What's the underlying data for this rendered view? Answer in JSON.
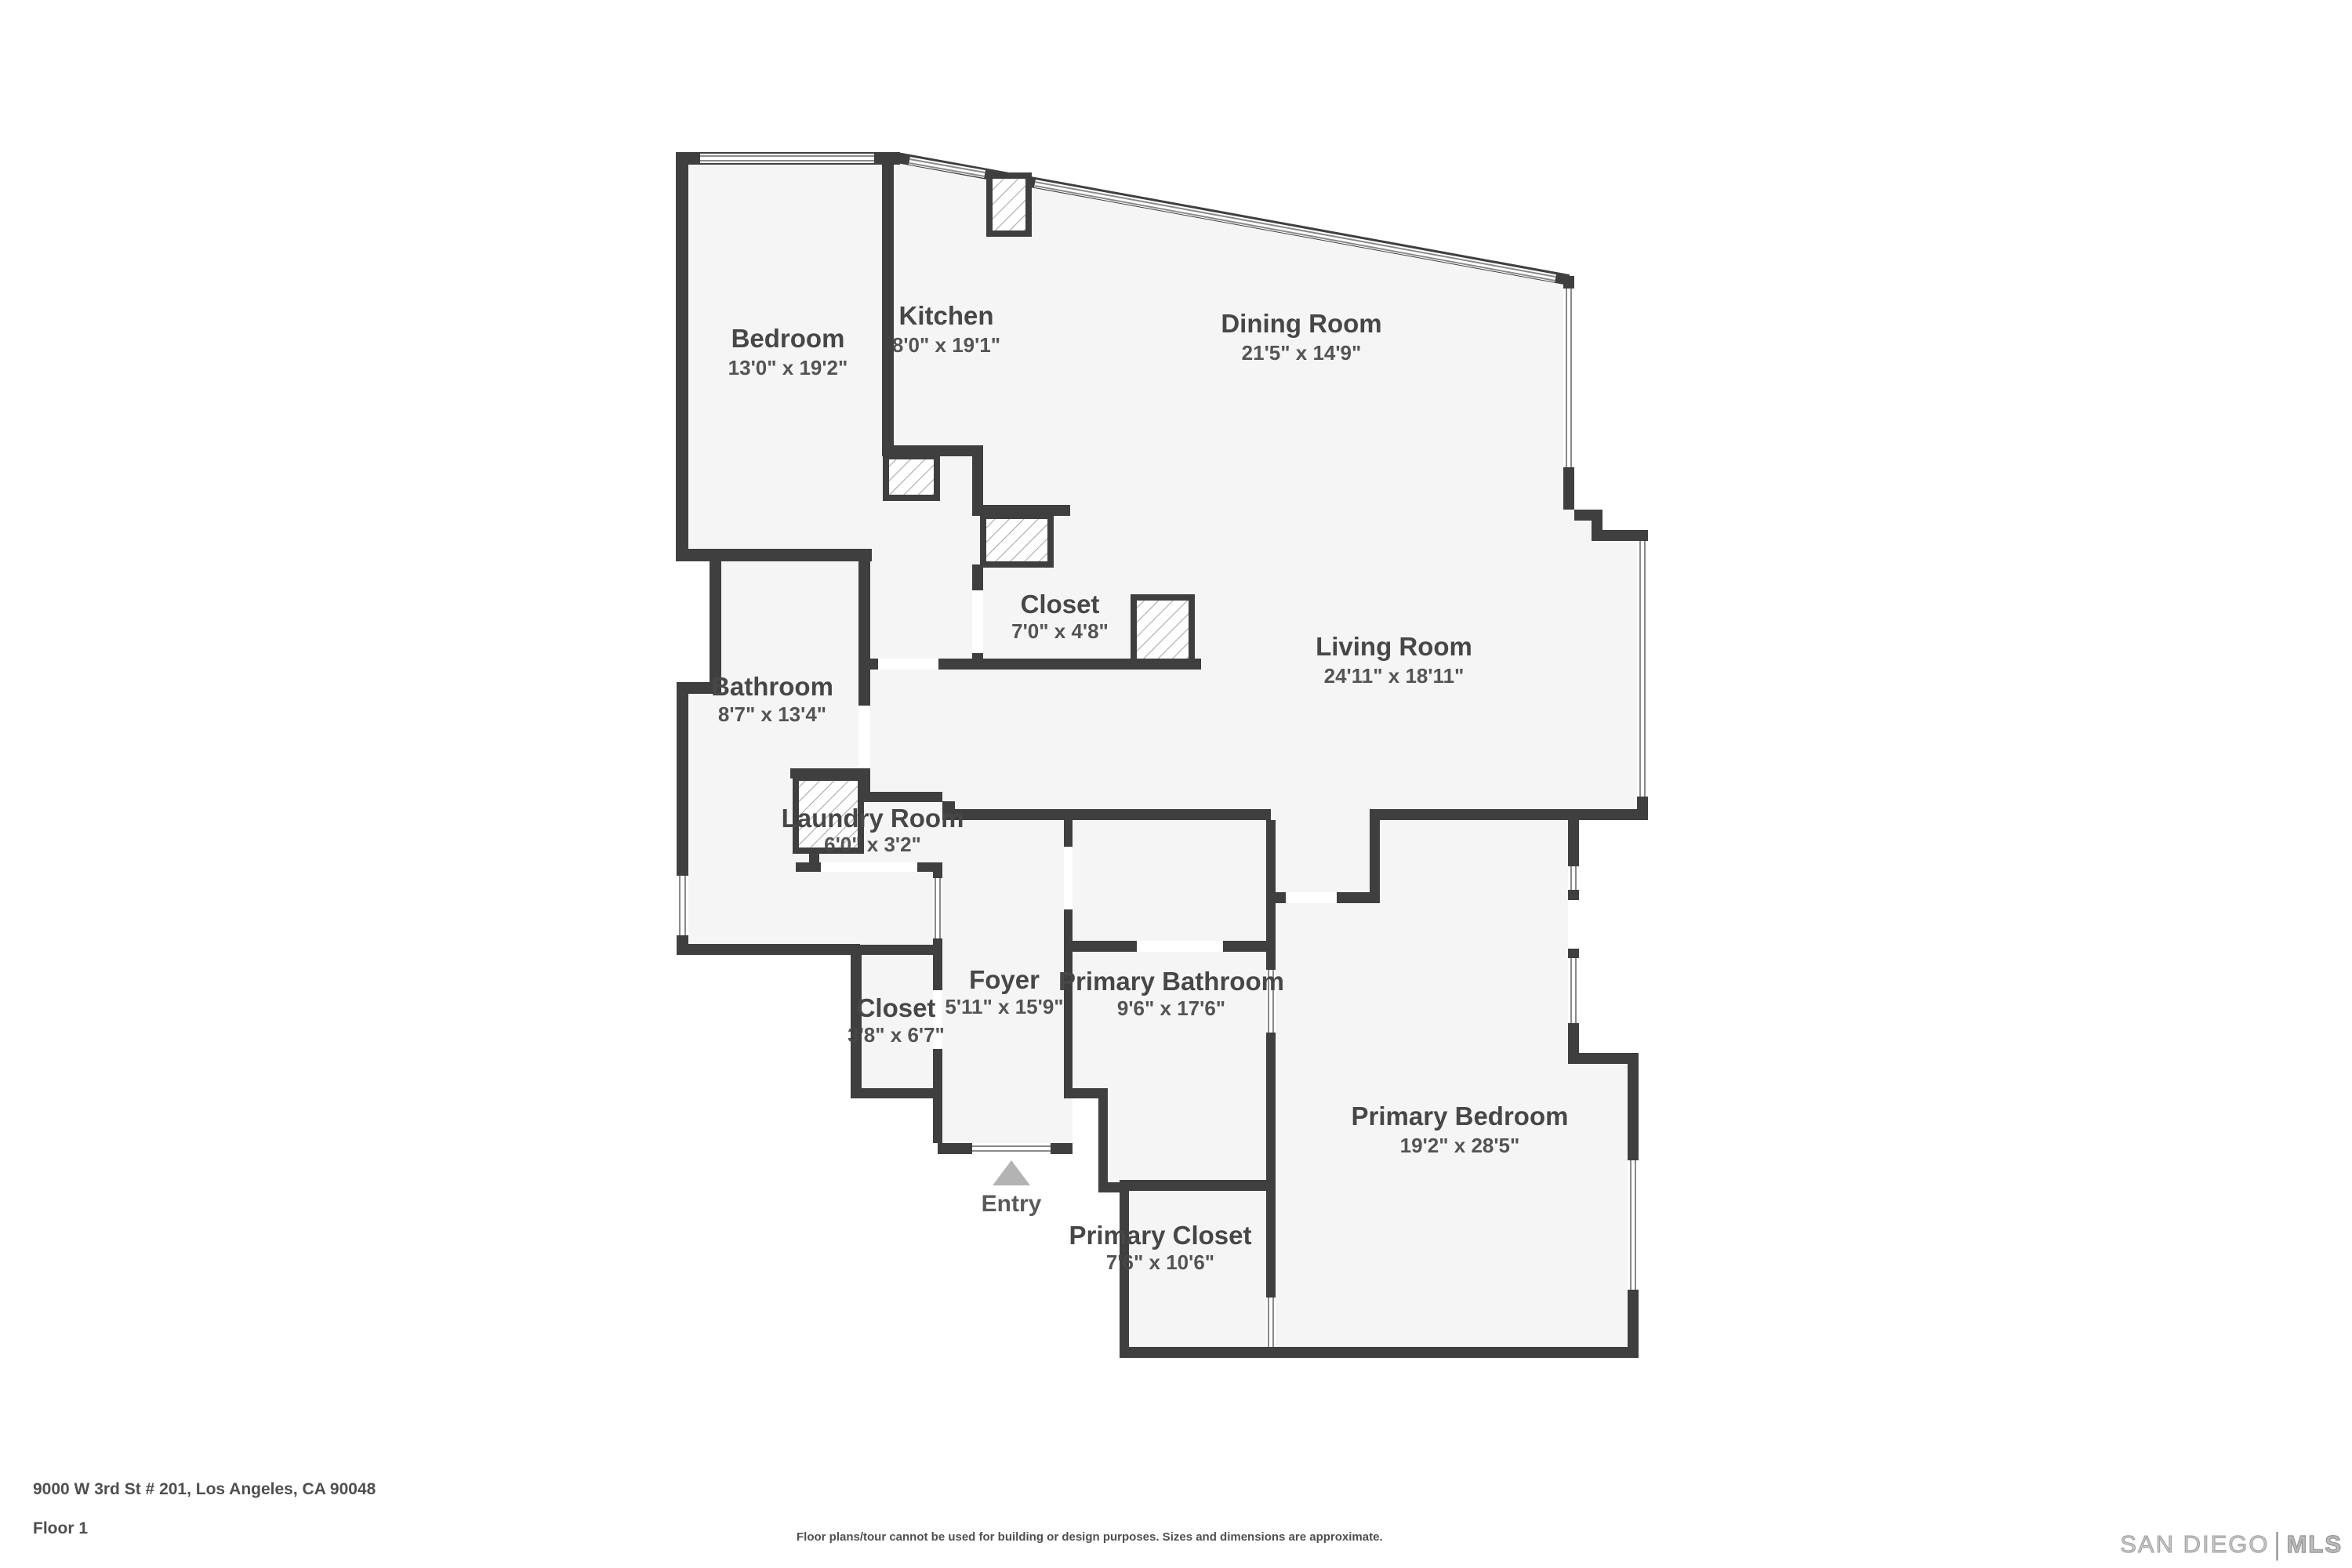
{
  "plan": {
    "rooms": [
      {
        "name": "Bedroom",
        "dims": "13'0\" x 19'2\""
      },
      {
        "name": "Kitchen",
        "dims": "8'0\" x 19'1\""
      },
      {
        "name": "Dining Room",
        "dims": "21'5\" x 14'9\""
      },
      {
        "name": "Closet",
        "dims": "7'0\" x 4'8\""
      },
      {
        "name": "Living Room",
        "dims": "24'11\" x 18'11\""
      },
      {
        "name": "Bathroom",
        "dims": "8'7\" x 13'4\""
      },
      {
        "name": "Laundry Room",
        "dims": "6'0\" x 3'2\""
      },
      {
        "name": "Closet",
        "dims": "3'8\" x 6'7\""
      },
      {
        "name": "Foyer",
        "dims": "5'11\" x 15'9\""
      },
      {
        "name": "Primary Bathroom",
        "dims": "9'6\" x 17'6\""
      },
      {
        "name": "Primary Closet",
        "dims": "7'6\" x 10'6\""
      },
      {
        "name": "Primary Bedroom",
        "dims": "19'2\" x 28'5\""
      }
    ],
    "entry_label": "Entry"
  },
  "footer": {
    "address": "9000 W 3rd St # 201, Los Angeles, CA 90048",
    "floor": "Floor 1",
    "disclaimer": "Floor plans/tour cannot be used for building or design purposes. Sizes and dimensions are approximate."
  },
  "watermark": {
    "part1": "SAN DIEGO",
    "separator": "|",
    "part2": "MLS"
  },
  "colors": {
    "wall": "#3f3f3f",
    "floor": "#f5f5f5",
    "label": "#474747",
    "window_line": "#8a8a8a",
    "entry_arrow": "#b3b3b3",
    "footer_text": "#4f4f4f",
    "watermark": "#b5b5b5"
  }
}
